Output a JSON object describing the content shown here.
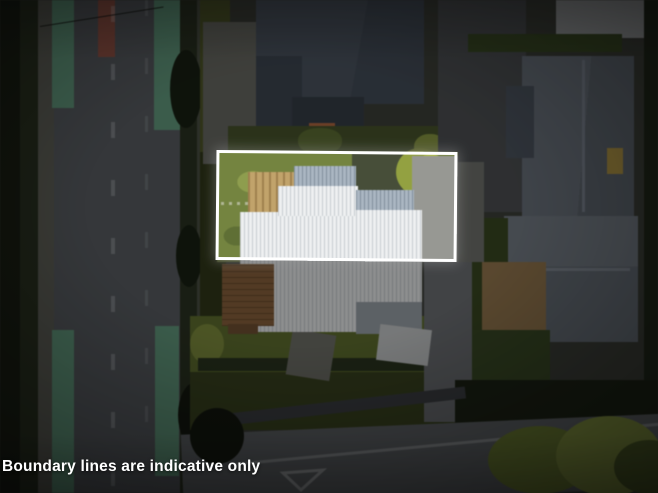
{
  "overlay": {
    "disclaimer": "Boundary lines are indicative only"
  },
  "colors": {
    "boundary_line": "#ffffff",
    "text_white": "#ffffff",
    "cycle_green": "#5f9b7c",
    "marking_red": "#9a5244",
    "asphalt": "#565a5f",
    "road_front": "#5f6367",
    "lawn_bright": "#74843d",
    "lawn_blob": "#8e9d4a",
    "lawn_front": "#5d6d28",
    "roof_white": "#eef0f1",
    "roof_blue": "#a9b6c3",
    "roof_dark_slate": "#49525f",
    "roof_grey_house": "#68707b",
    "flat_roof_light": "#9fa2a4",
    "driveway_light": "#979893",
    "pergola_wood": "#c2a368",
    "deck_wood": "#8a6038",
    "shed_roof": "#c7cacb",
    "dirt_tan": "#95764a",
    "shrub_bright": "#93a23c",
    "orange_item": "#b5663a",
    "skylight": "#b3963f"
  }
}
